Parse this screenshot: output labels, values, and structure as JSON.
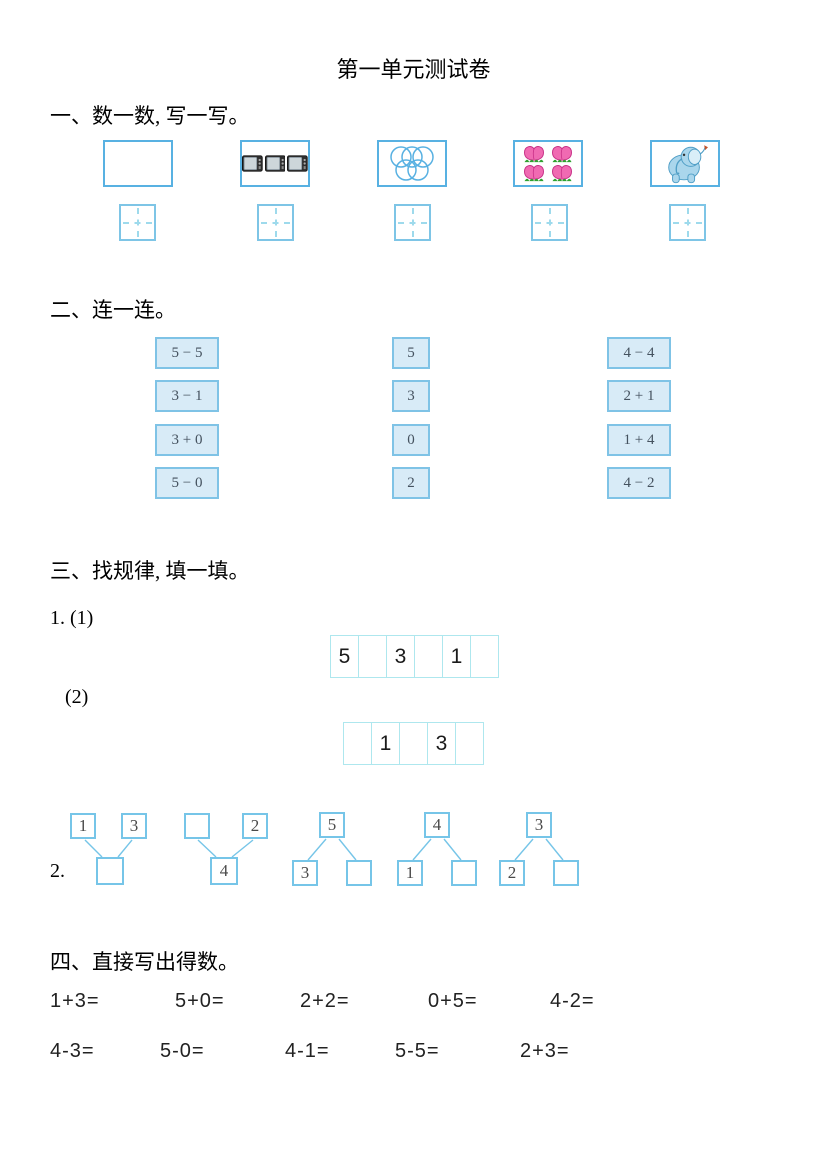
{
  "title": "第一单元测试卷",
  "section1": {
    "heading": "一、数一数, 写一写。",
    "pictures": [
      {
        "name": "empty-box",
        "count": 0
      },
      {
        "name": "televisions",
        "count": 3
      },
      {
        "name": "olympic-rings",
        "count": 5
      },
      {
        "name": "peaches",
        "count": 4
      },
      {
        "name": "elephant",
        "count": 1
      }
    ]
  },
  "section2": {
    "heading": "二、连一连。",
    "expressions_left": [
      "5 − 5",
      "3 − 1",
      "3 + 0",
      "5 − 0"
    ],
    "numbers_middle": [
      "5",
      "3",
      "0",
      "2"
    ],
    "expressions_right": [
      "4 − 4",
      "2 + 1",
      "1 + 4",
      "4 − 2"
    ]
  },
  "section3": {
    "heading": "三、找规律, 填一填。",
    "label_1": "1. (1)",
    "label_2": "(2)",
    "label_3": "2.",
    "strip1": [
      "5",
      "",
      "3",
      "",
      "1",
      ""
    ],
    "strip2": [
      "",
      "1",
      "",
      "3",
      ""
    ],
    "bonds": [
      {
        "tops": [
          "1",
          "3"
        ],
        "bottoms": [
          ""
        ]
      },
      {
        "tops": [
          "",
          "2"
        ],
        "bottoms": [
          "4"
        ]
      },
      {
        "tops": [
          "5"
        ],
        "bottoms": [
          "3",
          ""
        ]
      },
      {
        "tops": [
          "4"
        ],
        "bottoms": [
          "1",
          ""
        ]
      },
      {
        "tops": [
          "3"
        ],
        "bottoms": [
          "2",
          ""
        ]
      }
    ]
  },
  "section4": {
    "heading": "四、直接写出得数。",
    "row1": [
      "1+3=",
      "5+0=",
      "2+2=",
      "0+5=",
      "4-2="
    ],
    "row2": [
      "4-3=",
      "5-0=",
      "4-1=",
      "5-5=",
      "2+3="
    ]
  },
  "colors": {
    "picture_box_border": "#58b1e2",
    "writing_box_border": "#7ec5e6",
    "writing_box_cross": "#9edaec",
    "match_box_fill": "#d8ebf7",
    "match_box_border": "#7fc3e6",
    "strip_border": "#aee7ee",
    "bond_border": "#76c5e8"
  }
}
